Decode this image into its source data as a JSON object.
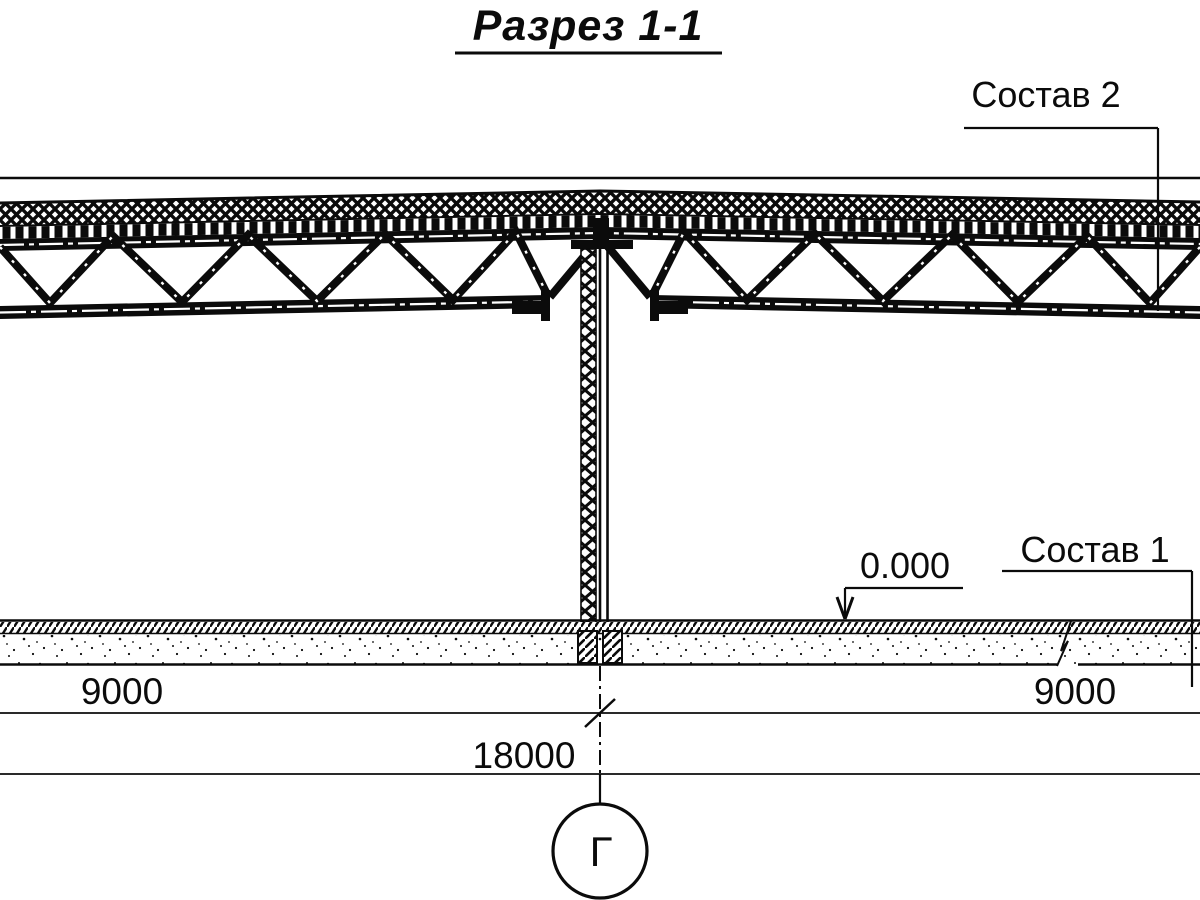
{
  "title": {
    "text": "Разрез 1-1"
  },
  "callouts": {
    "composition2": "Состав 2",
    "composition1": "Состав 1",
    "elevation_mark": "0.000"
  },
  "dimensions": {
    "left_span": "9000",
    "right_span": "9000",
    "total_span": "18000"
  },
  "axis_marker": {
    "label": "Г"
  },
  "colors": {
    "ink": "#0b0b0b",
    "paper": "#ffffff"
  }
}
